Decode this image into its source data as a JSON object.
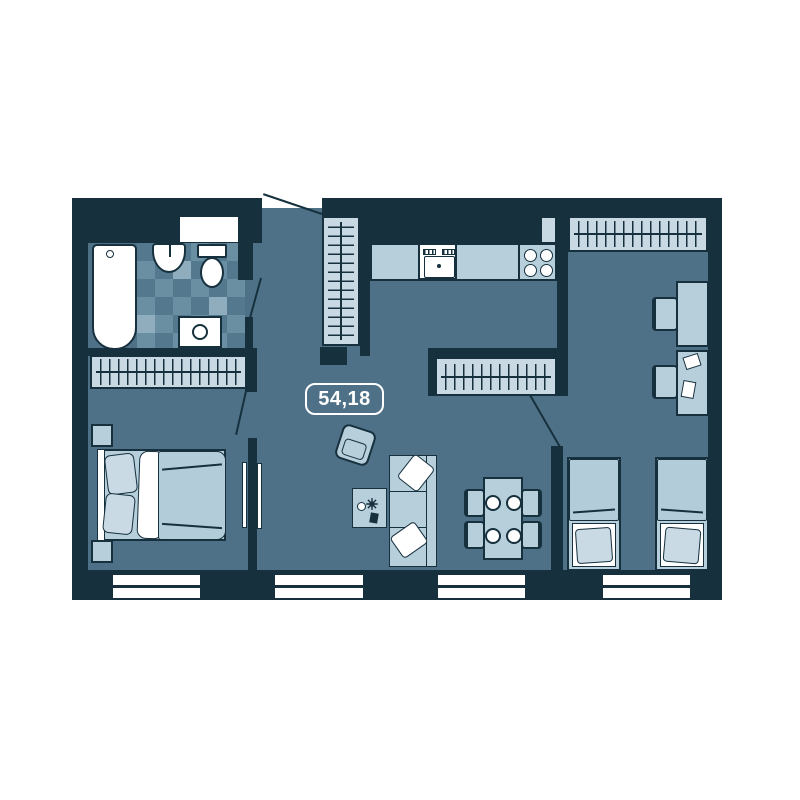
{
  "floorplan": {
    "area_label": "54,18",
    "colors": {
      "wall": "#16303e",
      "floor": "#4f7187",
      "tile": "#6b8fa2",
      "tile_dark": "#54788e",
      "tile_light": "#8fadbc",
      "furn": "#b7cedb",
      "furn_light": "#c8d9e3",
      "bedding": "#b3ccd9",
      "pillow": "#c9dae4",
      "white": "#ffffff"
    }
  }
}
